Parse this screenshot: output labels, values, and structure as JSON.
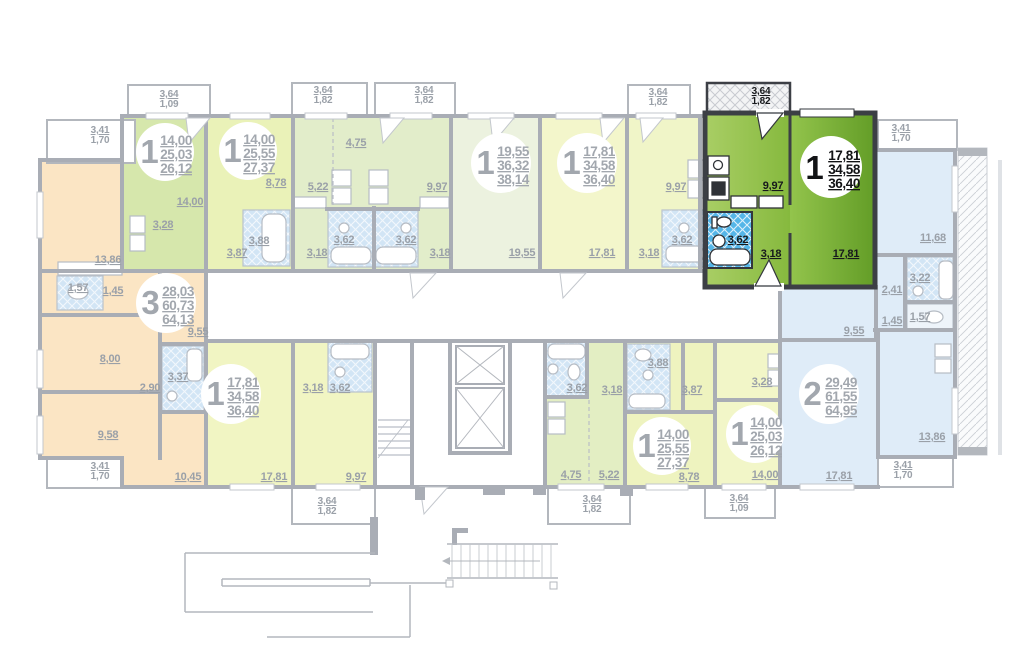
{
  "apartments": [
    {
      "rooms": "1",
      "living": "14,00",
      "area": "25,03",
      "total": "26,12"
    },
    {
      "rooms": "1",
      "living": "14,00",
      "area": "25,55",
      "total": "27,37"
    },
    {
      "rooms": "1",
      "living": "19,55",
      "area": "36,32",
      "total": "38,14"
    },
    {
      "rooms": "1",
      "living": "17,81",
      "area": "34,58",
      "total": "36,40"
    },
    {
      "rooms": "1",
      "living": "17,81",
      "area": "34,58",
      "total": "36,40",
      "selected": true
    },
    {
      "rooms": "3",
      "living": "28,03",
      "area": "60,73",
      "total": "64,13"
    },
    {
      "rooms": "1",
      "living": "17,81",
      "area": "34,58",
      "total": "36,40"
    },
    {
      "rooms": "1",
      "living": "14,00",
      "area": "25,55",
      "total": "27,37"
    },
    {
      "rooms": "1",
      "living": "14,00",
      "area": "25,03",
      "total": "26,12"
    },
    {
      "rooms": "2",
      "living": "29,49",
      "area": "61,55",
      "total": "64,95"
    }
  ],
  "room_labels": [
    "14,00",
    "3,28",
    "8,78",
    "4,75",
    "5,22",
    "9,97",
    "3,88",
    "3,87",
    "3,62",
    "3,62",
    "3,18",
    "3,18",
    "19,55",
    "17,81",
    "3,18",
    "3,62",
    "9,97",
    "9,97",
    "3,62",
    "3,18",
    "17,81",
    "13,86",
    "1,57",
    "1,45",
    "8,00",
    "9,58",
    "2,90",
    "3,37",
    "9,55",
    "10,45",
    "17,81",
    "3,18",
    "3,62",
    "9,97",
    "3,62",
    "4,75",
    "5,22",
    "3,88",
    "3,18",
    "3,87",
    "3,28",
    "8,78",
    "14,00",
    "11,68",
    "3,22",
    "2,41",
    "1,45",
    "1,57",
    "9,55",
    "13,86",
    "17,81"
  ],
  "balcony_labels": [
    {
      "a": "3,41",
      "b": "1,70"
    },
    {
      "a": "3,64",
      "b": "1,09"
    },
    {
      "a": "3,64",
      "b": "1,82"
    },
    {
      "a": "3,64",
      "b": "1,82"
    },
    {
      "a": "3,64",
      "b": "1,82"
    },
    {
      "a": "3,64",
      "b": "1,82"
    },
    {
      "a": "3,41",
      "b": "1,70"
    },
    {
      "a": "3,41",
      "b": "1,70"
    },
    {
      "a": "3,41",
      "b": "1,70"
    },
    {
      "a": "3,64",
      "b": "1,82"
    },
    {
      "a": "3,64",
      "b": "1,82"
    },
    {
      "a": "3,64",
      "b": "1,09"
    }
  ],
  "colors": {
    "selected_fill_light": "#93c44c",
    "selected_fill_dark": "#639d27",
    "selected_wall": "#3c3f45",
    "label_gray": "#9aa0a8",
    "bath_blue_selected": "#55b6e8",
    "bath_blue_faded": "#d2e5f5",
    "orange_apartment": "#fbe5c4",
    "blue_apartment": "#dfecf8",
    "wall_gray": "#a9adb5"
  }
}
